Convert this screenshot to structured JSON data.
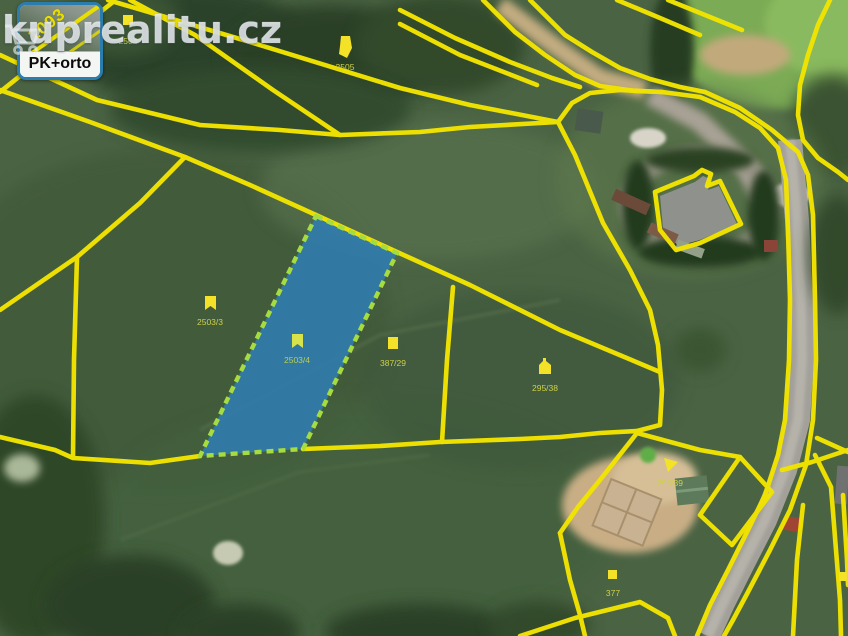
{
  "watermark": {
    "text": "kuprealitu.cz"
  },
  "layer_button": {
    "label": "PK+orto",
    "thumbnail_text": "1093"
  },
  "map": {
    "type": "cadastral-orthophoto",
    "line_color": "#f2e400",
    "selected_parcel": {
      "label": "2503/4",
      "fill_color": "#2f7cb2",
      "border_color": "#a6dc3f"
    },
    "parcel_labels": [
      {
        "text": "2504"
      },
      {
        "text": "2505"
      },
      {
        "text": "2503/3"
      },
      {
        "text": "2503/4"
      },
      {
        "text": "387/29"
      },
      {
        "text": "295/38"
      },
      {
        "text": "295/39"
      },
      {
        "text": "377"
      }
    ]
  }
}
